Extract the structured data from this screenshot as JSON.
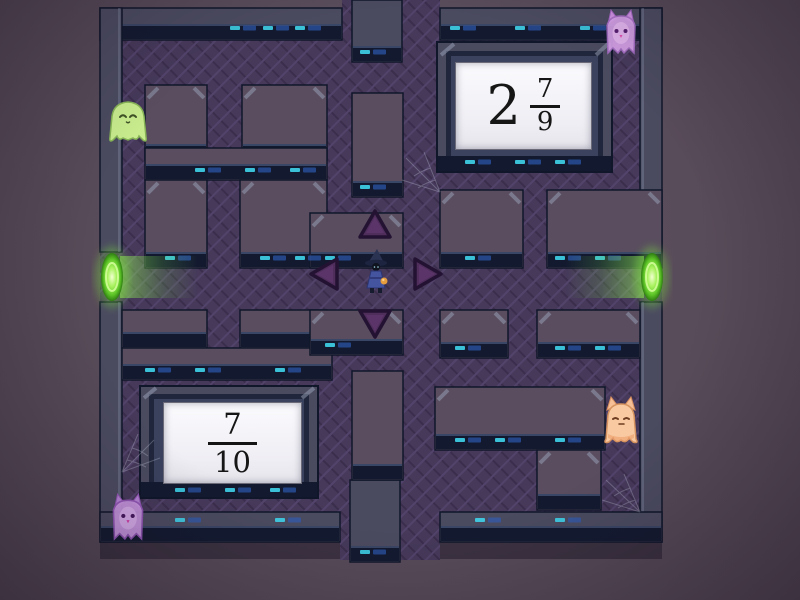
{
  "game": {
    "type": "maze-chase",
    "theme": "haunted-dungeon"
  },
  "answers": [
    {
      "position": "top-right",
      "whole": "2",
      "numerator": "7",
      "denominator": "9"
    },
    {
      "position": "bottom-left",
      "numerator": "7",
      "denominator": "10"
    }
  ],
  "player": {
    "name": "wizard",
    "robe_color": "#45549f",
    "hat_color": "#2b3352"
  },
  "ghosts": [
    {
      "position": "upper-left-corridor",
      "color_name": "green",
      "color": "#c8eb8d"
    },
    {
      "position": "top-right-corridor",
      "color_name": "pink",
      "color": "#d8a3ea"
    },
    {
      "position": "right-lower-corridor",
      "color_name": "orange",
      "color": "#f9c9a1"
    },
    {
      "position": "bottom-left-corridor",
      "color_name": "purple",
      "color": "#c795de"
    }
  ],
  "portals": [
    {
      "position": "left-middle",
      "color": "#7ae23c"
    },
    {
      "position": "right-middle",
      "color": "#7ae23c"
    }
  ],
  "controls": [
    {
      "direction": "up"
    },
    {
      "direction": "left"
    },
    {
      "direction": "right"
    },
    {
      "direction": "down"
    }
  ],
  "palette": {
    "background": "#594c5a",
    "corridor": "#46395a",
    "wall_top": "#594d5f",
    "wall_face": "#131a30",
    "light_cyan": "#3fd3ea",
    "light_blue": "#2e5cb8",
    "card_background": "#f4f3f7"
  }
}
